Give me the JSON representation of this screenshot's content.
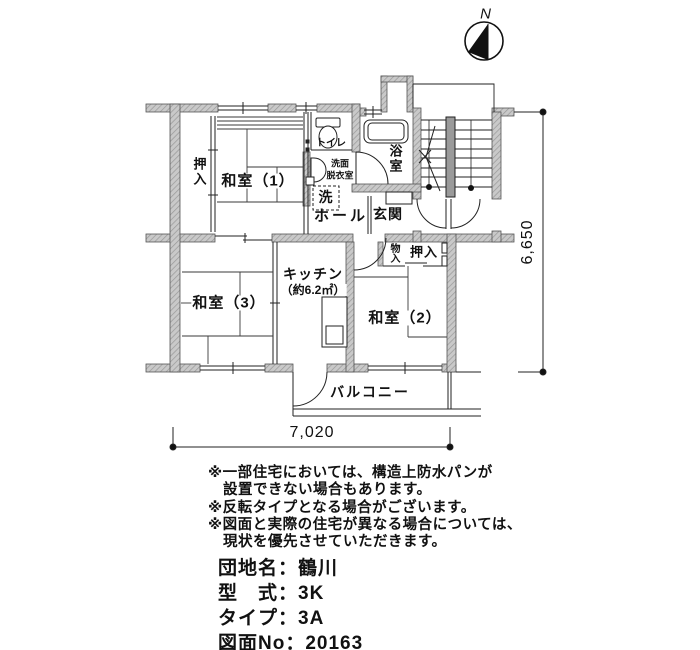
{
  "compass": {
    "north_label": "N"
  },
  "plan": {
    "rooms": {
      "oshiire_left": "押入",
      "washitsu1": "和室（1）",
      "toilet": "トイレ",
      "senmen_line1": "洗面",
      "senmen_line2": "脱衣室",
      "laundry": "洗",
      "hall": "ホール",
      "genkan": "玄関",
      "bath": "浴室",
      "monoire": "物入",
      "oshiire_right": "押入",
      "kitchen": "キッチン",
      "kitchen_area": "（約6.2㎡）",
      "washitsu3": "和室（3）",
      "washitsu2": "和室（2）",
      "balcony": "バルコニー"
    },
    "dimensions": {
      "width_mm": "7,020",
      "height_mm": "6,650"
    }
  },
  "notes": [
    "※一部住宅においては、構造上防水パンが",
    "　設置できない場合もあります。",
    "※反転タイプとなる場合がございます。",
    "※図面と実際の住宅が異なる場合については、",
    "　現状を優先させていただきます。"
  ],
  "property": {
    "lines": [
      "団地名：鶴川",
      "型　式：3K",
      "タイプ：3A",
      "図面No：20163"
    ]
  }
}
